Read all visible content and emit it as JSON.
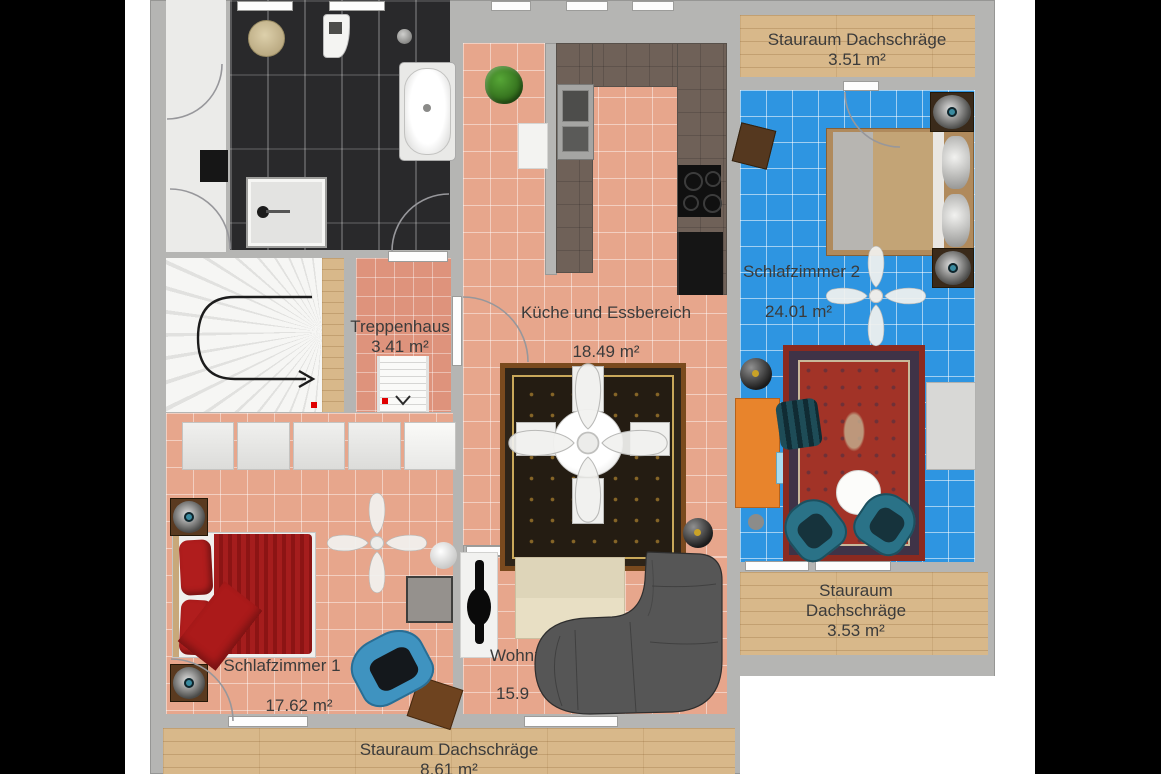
{
  "rooms": {
    "stauraum_top": {
      "name": "Stauraum Dachschräge",
      "area": "3.51 m²"
    },
    "schlafzimmer2": {
      "name": "Schlafzimmer 2",
      "area": "24.01 m²"
    },
    "kueche": {
      "name": "Küche und Essbereich",
      "area": "18.49 m²"
    },
    "treppenhaus": {
      "name": "Treppenhaus",
      "area": "3.41 m²"
    },
    "schlafzimmer1": {
      "name": "Schlafzimmer 1",
      "area": "17.62 m²"
    },
    "wohnzimmer": {
      "name": "Wohnzimmer",
      "area": "15.9"
    },
    "stauraum_right": {
      "name": "Stauraum Dachschräge",
      "area": "3.53 m²"
    },
    "stauraum_bottom": {
      "name": "Stauraum Dachschräge",
      "area": "8.61 m²"
    }
  },
  "colors": {
    "floor_salmon": "#e7a68c",
    "floor_blue": "#2e95e1",
    "floor_wood": "#d8b88a",
    "floor_dark_tile": "#29292b",
    "wall": "#b5b5b3",
    "desk_orange": "#e8842c",
    "bed_red": "#a51d1d",
    "chair_teal": "#2a7287",
    "sofa_gray": "#565656"
  }
}
